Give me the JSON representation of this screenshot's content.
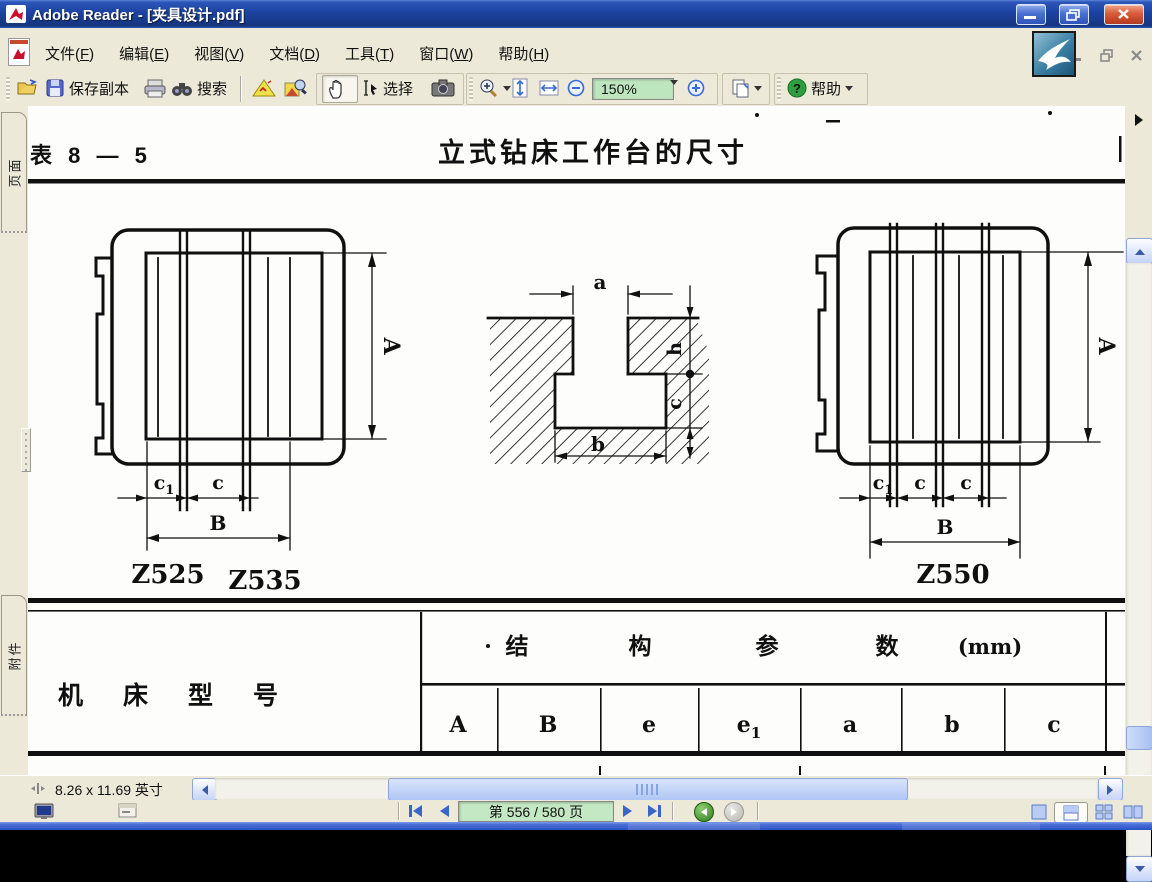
{
  "window": {
    "title": "Adobe Reader - [夹具设计.pdf]"
  },
  "menu": {
    "items": [
      {
        "pre": "文件(",
        "key": "F",
        "post": ")"
      },
      {
        "pre": "编辑(",
        "key": "E",
        "post": ")"
      },
      {
        "pre": "视图(",
        "key": "V",
        "post": ")"
      },
      {
        "pre": "文档(",
        "key": "D",
        "post": ")"
      },
      {
        "pre": "工具(",
        "key": "T",
        "post": ")"
      },
      {
        "pre": "窗口(",
        "key": "W",
        "post": ")"
      },
      {
        "pre": "帮助(",
        "key": "H",
        "post": ")"
      }
    ]
  },
  "toolbar": {
    "save_copy": "保存副本",
    "search": "搜索",
    "select": "选择",
    "zoom_value": "150%",
    "help": "帮助",
    "accent_green": "#BEE6BE"
  },
  "sidebar": {
    "pages": "页面",
    "attachments": "附件"
  },
  "doc": {
    "table_label": "表 8 — 5",
    "title": "立式钻床工作台的尺寸",
    "left": {
      "model1": "Z525",
      "model2": "Z535",
      "A": "A",
      "B": "B",
      "c": "c",
      "c1": {
        "base": "c",
        "sub": "1"
      }
    },
    "mid": {
      "a": "a",
      "b": "b",
      "h": "h",
      "c": "c"
    },
    "right": {
      "model": "Z550",
      "A": "A",
      "B": "B",
      "c1": {
        "base": "c",
        "sub": "1"
      },
      "c2": "c",
      "c3": "c"
    },
    "table": {
      "row_header": "机床型号",
      "group_header": [
        "结",
        "构",
        "参",
        "数",
        "(mm)"
      ],
      "columns": [
        "A",
        "B",
        "e",
        {
          "base": "e",
          "sub": "1"
        },
        "a",
        "b",
        "c"
      ]
    }
  },
  "status": {
    "page_size": "8.26 x 11.69 英寸"
  },
  "nav": {
    "page": "第 556 / 580 页"
  }
}
